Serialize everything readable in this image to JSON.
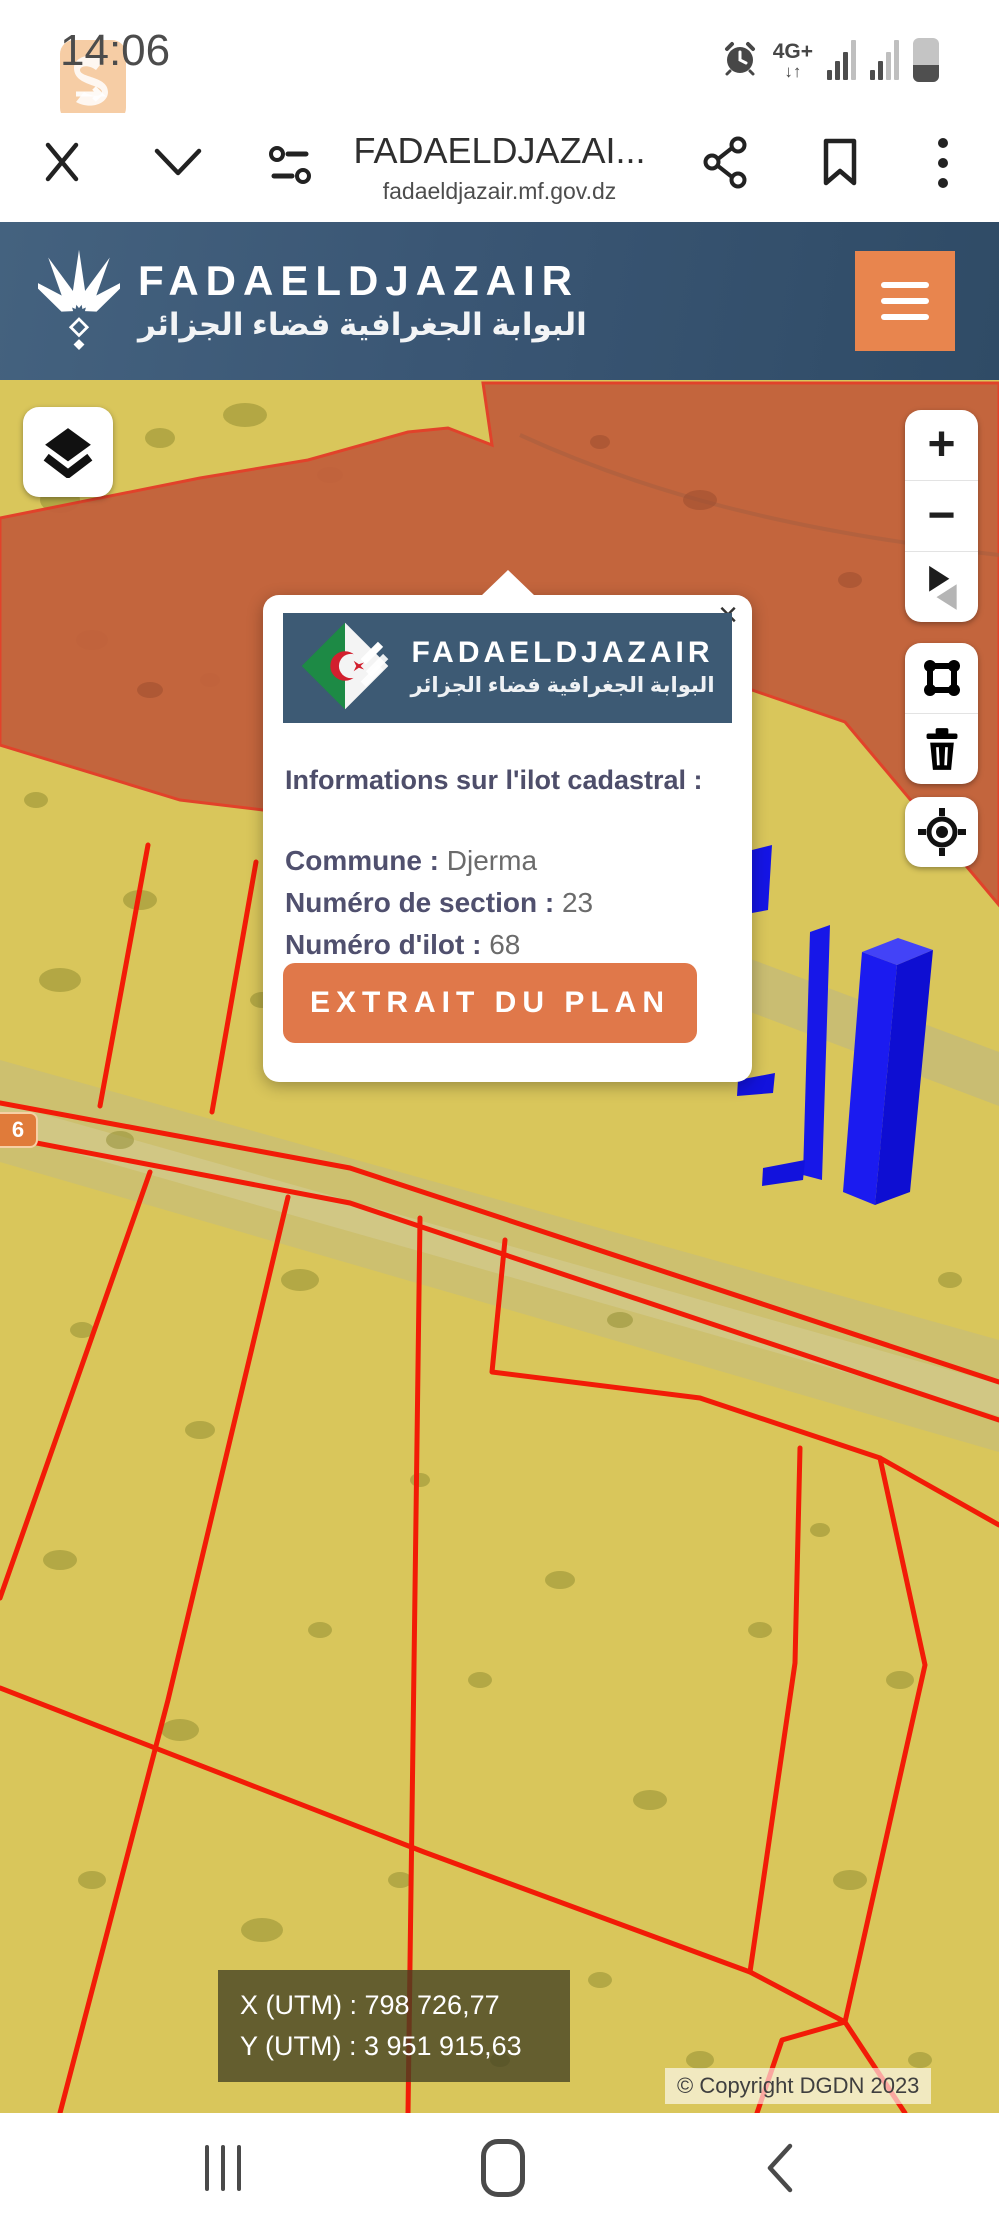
{
  "status_bar": {
    "time": "14:06",
    "network_label": "4G+",
    "network_arrows": "↓↑"
  },
  "watermark": {
    "text": "Swiga | سويقة"
  },
  "browser": {
    "title": "FADAELDJAZAI...",
    "url": "fadaeldjazair.mf.gov.dz"
  },
  "site_header": {
    "brand": "FADAELDJAZAIR",
    "brand_ar": "البوابة الجغرافية فضاء الجزائر"
  },
  "map": {
    "route_badge": "6",
    "controls": {
      "zoom_in": "+",
      "zoom_out": "−"
    },
    "popup": {
      "close_label": "×",
      "banner": {
        "brand": "FADAELDJAZAIR",
        "brand_ar": "البوابة الجغرافية فضاء الجزائر"
      },
      "heading": "Informations sur l'ilot cadastral :",
      "rows": [
        {
          "label": "Commune",
          "sep": " : ",
          "value": "Djerma"
        },
        {
          "label": "Numéro de section",
          "sep": " : ",
          "value": "23"
        },
        {
          "label": "Numéro d'ilot",
          "sep": " : ",
          "value": "68"
        }
      ],
      "action_label": "EXTRAIT DU PLAN"
    },
    "coordinates": {
      "x_line": "X (UTM) : 798 726,77",
      "y_line": "Y (UTM) : 3 951 915,63"
    },
    "copyright": "© Copyright DGDN 2023",
    "colors": {
      "terrain_yellow": "#d9c65b",
      "zone_orange": "#c2603c",
      "parcel_red": "#f21b07",
      "building_blue": "#1717e8",
      "accent_orange": "#e8854e",
      "header_slate": "#3d5a74"
    }
  }
}
